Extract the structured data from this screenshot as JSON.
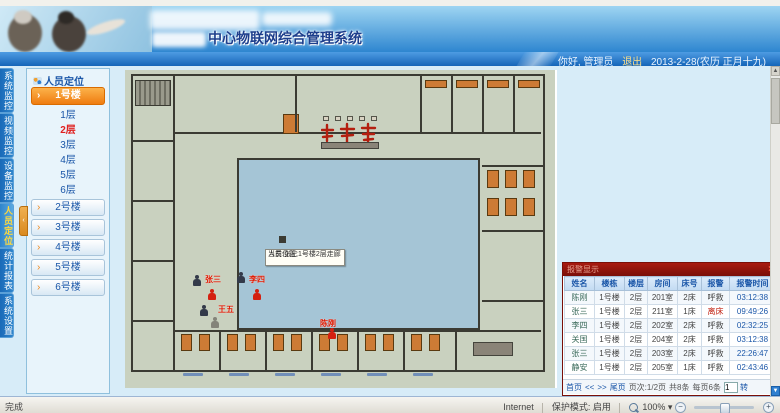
{
  "header": {
    "title": "中心物联网综合管理系统",
    "greeting": "你好, 管理员",
    "logout": "退出",
    "date": "2013-2-28(农历 正月十九)"
  },
  "nav": {
    "tabs": [
      {
        "label": "系统监控"
      },
      {
        "label": "视频监控"
      },
      {
        "label": "设备监控"
      },
      {
        "label": "人员定位",
        "active": true
      },
      {
        "label": "统计报表"
      },
      {
        "label": "系统设置"
      }
    ]
  },
  "sidebar": {
    "title": "人员定位",
    "buildings": [
      {
        "label": "1号楼",
        "active": true
      },
      {
        "label": "2号楼"
      },
      {
        "label": "3号楼"
      },
      {
        "label": "4号楼"
      },
      {
        "label": "5号楼"
      },
      {
        "label": "6号楼"
      }
    ],
    "floors": [
      {
        "label": "1层"
      },
      {
        "label": "2层",
        "active": true
      },
      {
        "label": "3层"
      },
      {
        "label": "4层"
      },
      {
        "label": "5层"
      },
      {
        "label": "6层"
      }
    ]
  },
  "plan": {
    "persons": [
      {
        "name": "张三"
      },
      {
        "name": "李四"
      },
      {
        "name": "王五"
      },
      {
        "name": "陈刚"
      }
    ],
    "tooltip": {
      "line1": "人员:张三",
      "line2": "当前位置:1号楼2层走廊"
    }
  },
  "alarm": {
    "title": "报警显示",
    "close": "×",
    "columns": [
      "姓名",
      "楼栋",
      "楼层",
      "房间",
      "床号",
      "报警",
      "报警时间"
    ],
    "rows": [
      [
        "陈刚",
        "1号楼",
        "2层",
        "201室",
        "2床",
        "呼救",
        "03:12:38"
      ],
      [
        "张三",
        "1号楼",
        "2层",
        "211室",
        "1床",
        "离床",
        "09:49:26"
      ],
      [
        "李四",
        "1号楼",
        "2层",
        "202室",
        "2床",
        "呼救",
        "02:32:25"
      ],
      [
        "关国",
        "1号楼",
        "2层",
        "204室",
        "2床",
        "呼救",
        "03:12:38"
      ],
      [
        "张三",
        "1号楼",
        "2层",
        "203室",
        "2床",
        "呼救",
        "22:26:47"
      ],
      [
        "静安",
        "1号楼",
        "2层",
        "205室",
        "1床",
        "呼救",
        "02:43:46"
      ]
    ],
    "pagination": {
      "first": "首页",
      "prev": "<<",
      "next": ">>",
      "last": "尾页",
      "page_info": "页次:1/2页",
      "total": "共8条",
      "per_page": "每页6条",
      "goto_value": "1",
      "go_label": "转"
    }
  },
  "icons": {
    "scroll_up": "▲",
    "scroll_down": "▼",
    "dropdown": "▾",
    "collapse": "‹"
  },
  "statusbar": {
    "done": "完成",
    "zone": "Internet",
    "protection": "保护模式: 启用",
    "zoom_level": "100%"
  }
}
